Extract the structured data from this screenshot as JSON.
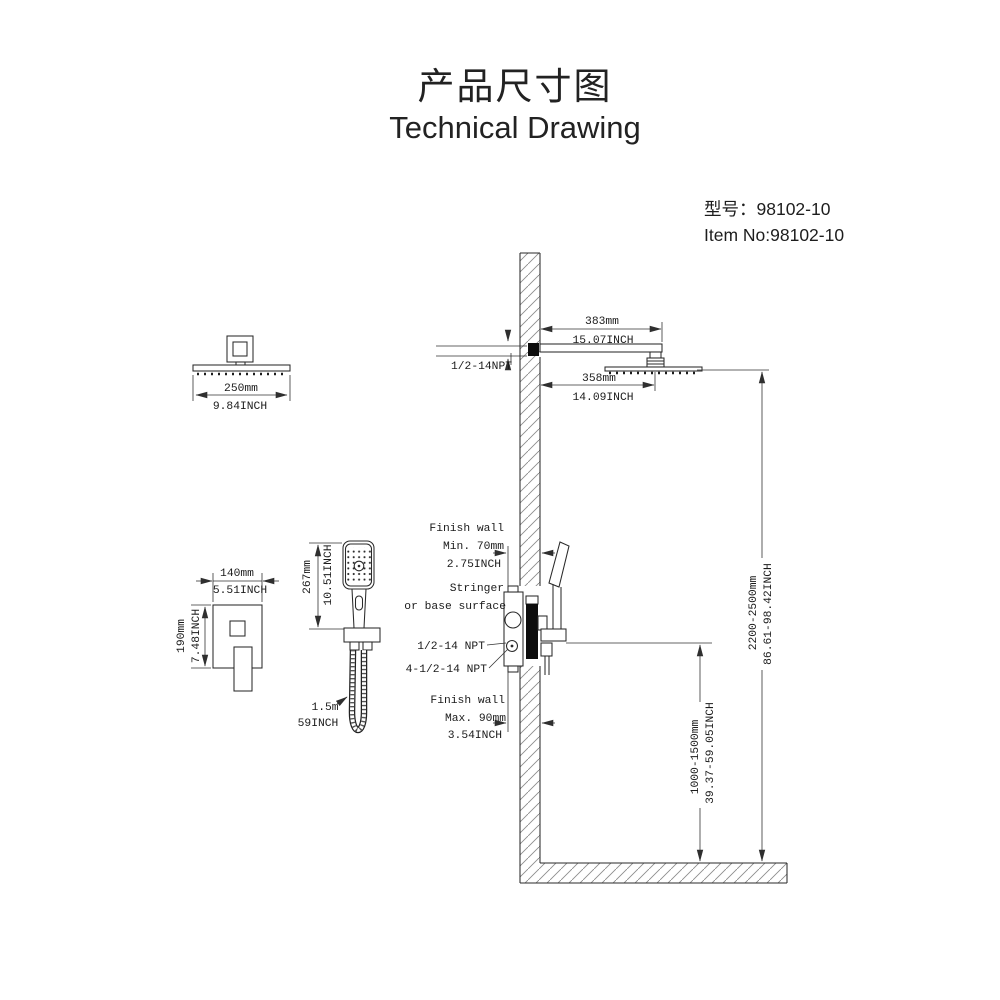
{
  "title": {
    "chinese": "产品尺寸图",
    "english": "Technical Drawing"
  },
  "model": {
    "model_no": "型号：98102-10",
    "item_no": "Item No:98102-10"
  },
  "colors": {
    "line": "#2a2a2a",
    "dimension_line": "#333333",
    "text": "#1b1b1b",
    "solid_black": "#0d0d0d",
    "hatch": "#8c8c8c",
    "background": "#ffffff"
  },
  "dimensions": {
    "head_width_mm": "250mm",
    "head_width_inch": "9.84INCH",
    "arm_length_mm": "383mm",
    "arm_length_inch": "15.07INCH",
    "arm_to_head_mm": "358mm",
    "arm_to_head_inch": "14.09INCH",
    "valve_width_mm": "140mm",
    "valve_width_inch": "5.51INCH",
    "valve_height_mm": "190mm",
    "valve_height_inch": "7.48INCH",
    "hand_shower_mm": "267mm",
    "hand_shower_inch": "10.51INCH",
    "hose_m": "1.5m",
    "hose_inch": "59INCH",
    "head_height_range_mm": "2200-2500mm",
    "head_height_range_inch": "86.61-98.42INCH",
    "valve_height_range_mm": "1000-1500mm",
    "valve_height_range_inch": "39.37-59.05INCH"
  },
  "callouts": {
    "arm_thread": "1/2-14NPT",
    "valve_thread_1": "1/2-14 NPT",
    "valve_thread_2": "4-1/2-14 NPT",
    "finish_wall_min_line1": "Finish wall",
    "finish_wall_min_line2": "Min. 70mm",
    "finish_wall_min_line3": "2.75INCH",
    "stringer_line1": "Stringer",
    "stringer_line2": "or base surface",
    "finish_wall_max_line1": "Finish wall",
    "finish_wall_max_line2": "Max. 90mm",
    "finish_wall_max_line3": "3.54INCH"
  }
}
